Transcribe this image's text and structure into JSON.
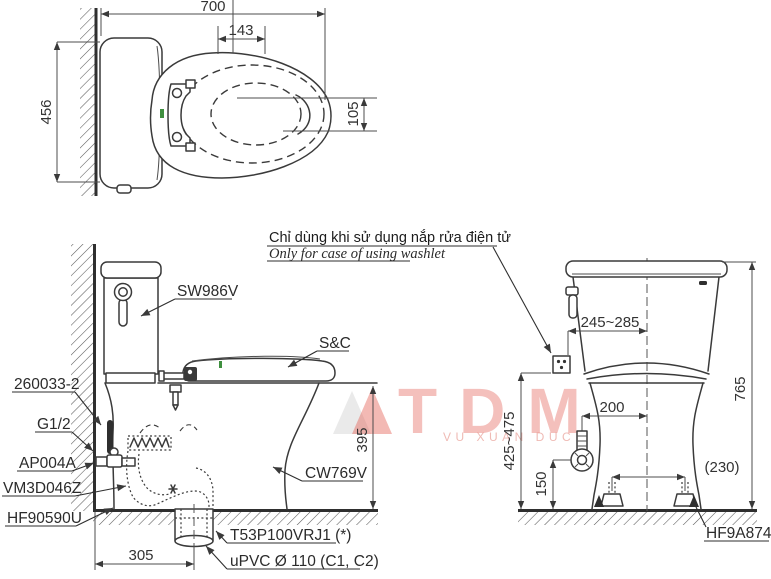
{
  "note": {
    "vi": "Chỉ dùng khi sử dụng nắp rửa điện tử",
    "en": "Only for case of using washlet"
  },
  "top_view": {
    "dim_width": "700",
    "dim_seat_bolt": "143",
    "dim_depth": "456",
    "dim_center_offset": "105"
  },
  "side_view": {
    "tank": "SW986V",
    "seat": "S&C",
    "bowl": "CW769V",
    "inlet_hose": "260033-2",
    "thread": "G1/2",
    "stop_valve": "AP004A",
    "flange": "VM3D046Z",
    "floor_seal": "HF90590U",
    "drain_socket": "T53P100VRJ1 (*)",
    "drain_pipe": "uPVC Ø 110 (C1, C2)",
    "dim_rim_height": "395",
    "dim_rough_in": "305"
  },
  "front_view": {
    "dim_washlet_supply": "245~285",
    "dim_height": "765",
    "dim_supply_center": "200",
    "dim_supply_height": "150",
    "dim_bolt_caps": "(230)",
    "dim_washlet_supply_height": "425~475",
    "bolt_cap": "HF9A874"
  },
  "watermark": {
    "brand": "TDM",
    "sub": "VU XUAN DUC"
  },
  "colors": {
    "line": "#3a3a3a",
    "green_mark": "#3f8f3f",
    "watermark": "#e15a4a"
  }
}
